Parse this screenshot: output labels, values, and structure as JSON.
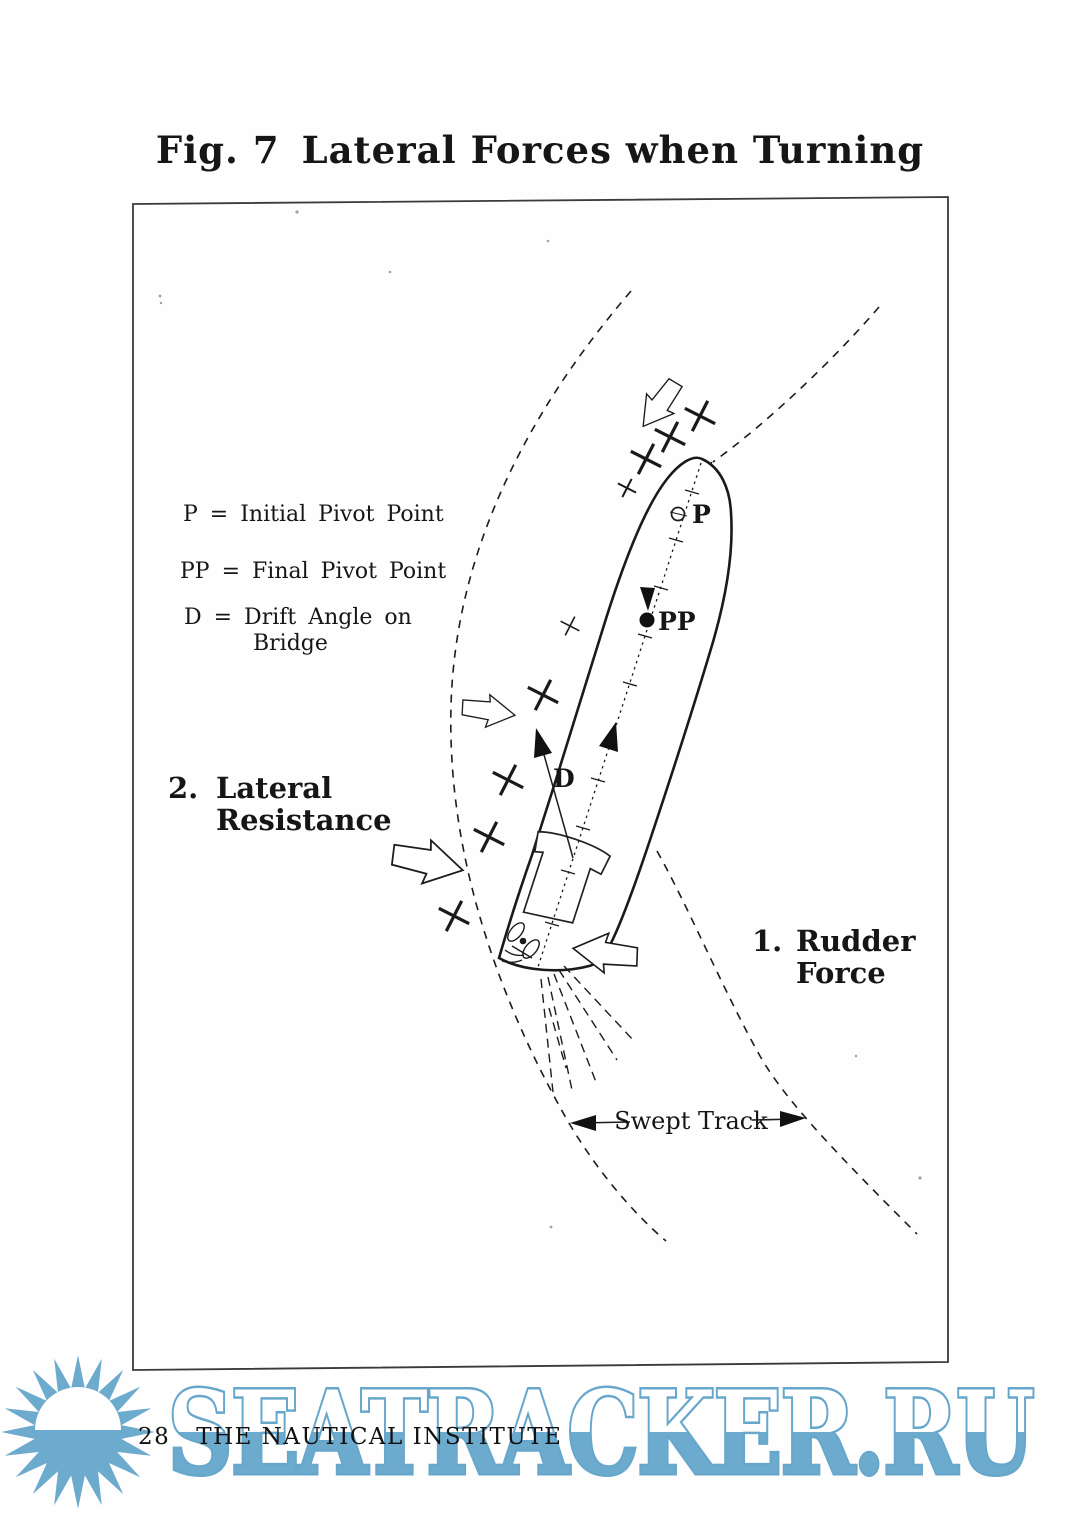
{
  "page": {
    "figure_label": "Fig. 7",
    "figure_title": "Lateral Forces when Turning",
    "page_number": "28",
    "publisher": "THE NAUTICAL INSTITUTE"
  },
  "legend": {
    "initial_pivot": "P  = Initial Pivot Point",
    "final_pivot": "PP = Final Pivot Point",
    "drift_angle_1": "D  = Drift Angle on",
    "drift_angle_2": "Bridge"
  },
  "diagram_labels": {
    "pivot_initial": "P",
    "pivot_final": "PP",
    "drift_angle": "D",
    "lateral_number": "2.",
    "lateral_line1": "Lateral",
    "lateral_line2": "Resistance",
    "rudder_number": "1.",
    "rudder_line1": "Rudder",
    "rudder_line2": "Force",
    "swept_track": "Swept Track"
  },
  "watermark": {
    "text": "SEATRACKER.RU",
    "color": "#6dabce"
  }
}
